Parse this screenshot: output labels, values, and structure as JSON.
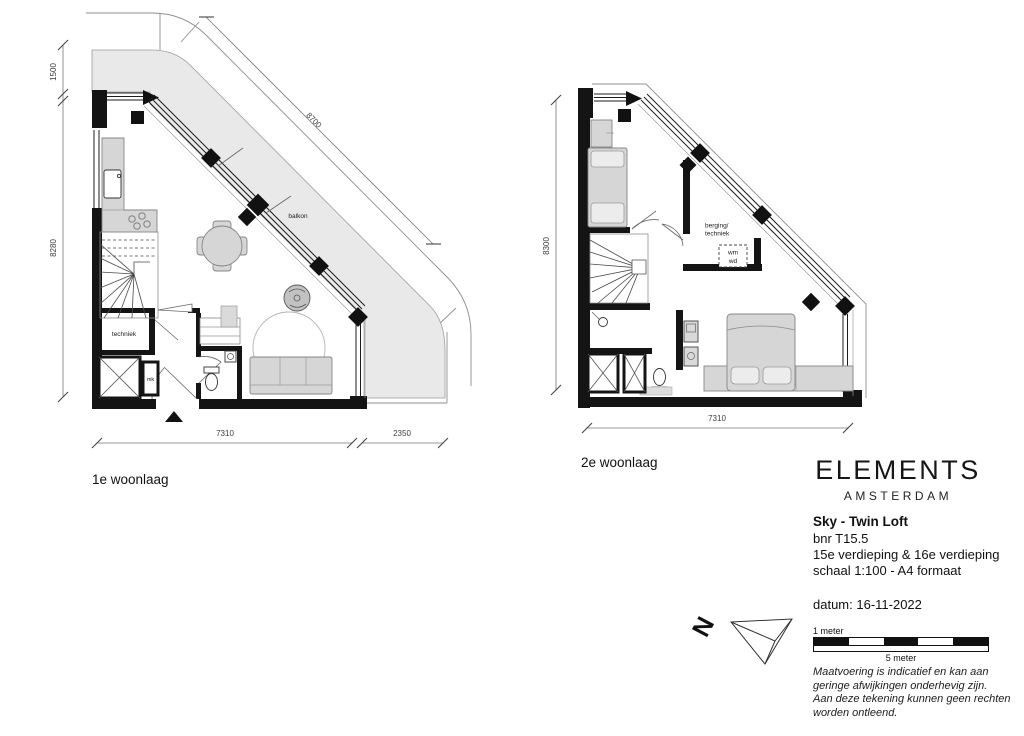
{
  "colors": {
    "wall": "#141414",
    "balcony_fill": "#e9e9e9",
    "furniture_fill": "#d6d6d6",
    "line": "#8f8f8f"
  },
  "plan1": {
    "title": "1e woonlaag",
    "labels": {
      "balkon": "balkon",
      "techniek": "techniek",
      "mk": "mk"
    },
    "dims": {
      "d1500": "1500",
      "d8280": "8280",
      "d8700": "8700",
      "d7310": "7310",
      "d2350": "2350"
    }
  },
  "plan2": {
    "title": "2e woonlaag",
    "labels": {
      "berging1": "berging/",
      "berging2": "techniek",
      "wm": "wm",
      "wd": "wd"
    },
    "dims": {
      "d8300": "8300",
      "d7310": "7310"
    }
  },
  "titleblock": {
    "brand": "ELEMENTS",
    "brand_city": "AMSTERDAM",
    "unit": "Sky - Twin Loft",
    "bnr": "bnr T15.5",
    "floors": "15e verdieping & 16e verdieping",
    "scale": "schaal 1:100 - A4 formaat",
    "date": "datum: 16-11-2022"
  },
  "north": {
    "letter": "N"
  },
  "scalebar": {
    "label_top": "1 meter",
    "label_bottom": "5 meter"
  },
  "disclaimer": [
    "Maatvoering is indicatief en kan aan",
    "geringe afwijkingen onderhevig zijn.",
    "Aan deze tekening kunnen geen rechten",
    "worden ontleend."
  ]
}
